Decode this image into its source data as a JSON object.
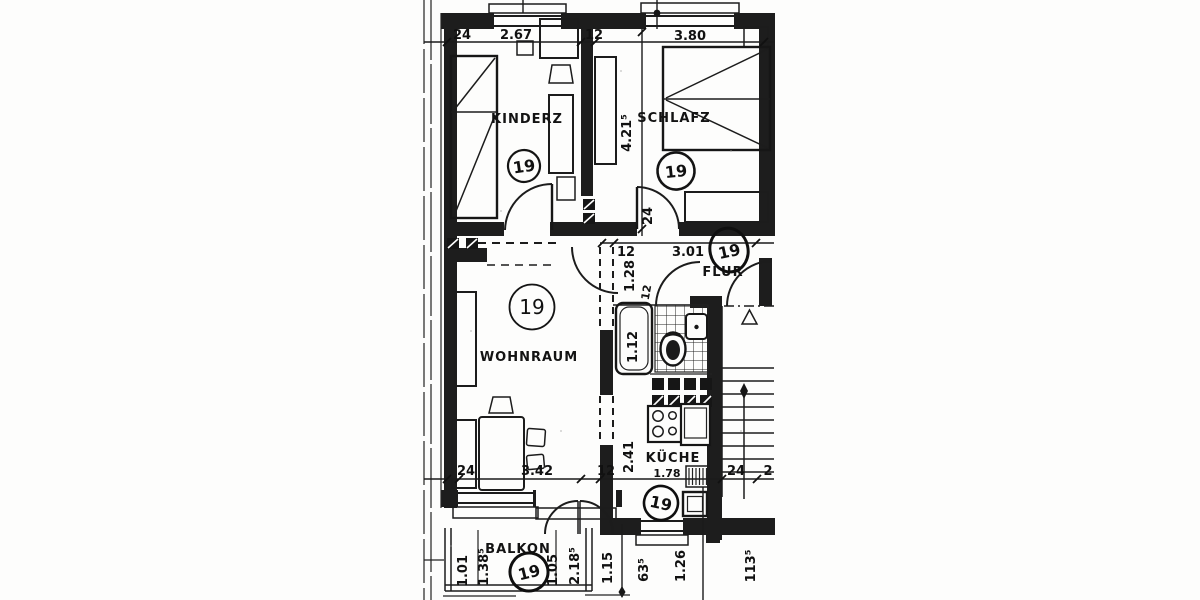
{
  "plan": {
    "rooms": {
      "kinderz": {
        "name": "KINDERZ",
        "unit": "19"
      },
      "schlafz": {
        "name": "SCHLAFZ",
        "unit": "19"
      },
      "wohnraum": {
        "name": "WOHNRAUM",
        "unit": "19"
      },
      "flur": {
        "name": "FLUR",
        "unit": "19"
      },
      "kueche": {
        "name": "KÜCHE",
        "unit": "19"
      },
      "balkon": {
        "name": "BALKON",
        "unit": "19"
      }
    },
    "dims": {
      "top_wall": "24",
      "top_kinderz": "2.67",
      "top_partition": "12",
      "top_schlafz": "3.80",
      "schlafz_depth": "4.21⁵",
      "schlafz_wall": "24",
      "flur_wall": "12",
      "flur_width": "3.01",
      "flur_opening": "1.28",
      "flur_jamb": "12",
      "bad_tub": "1.12",
      "kueche_depth": "2.41",
      "kueche_width": "1.78",
      "bottom_wall": "24",
      "bottom_wohnraum": "3.42",
      "bottom_partition": "12",
      "bottom_stair_wall": "24",
      "bottom_stair_part": "2",
      "balkon_1": "1.01",
      "balkon_2": "1.38⁵",
      "balkon_3": "1.05",
      "balkon_4": "2.18⁵",
      "below_1": "1.15",
      "below_2": "63⁵",
      "below_3": "1.26",
      "below_4": "113⁵"
    }
  }
}
